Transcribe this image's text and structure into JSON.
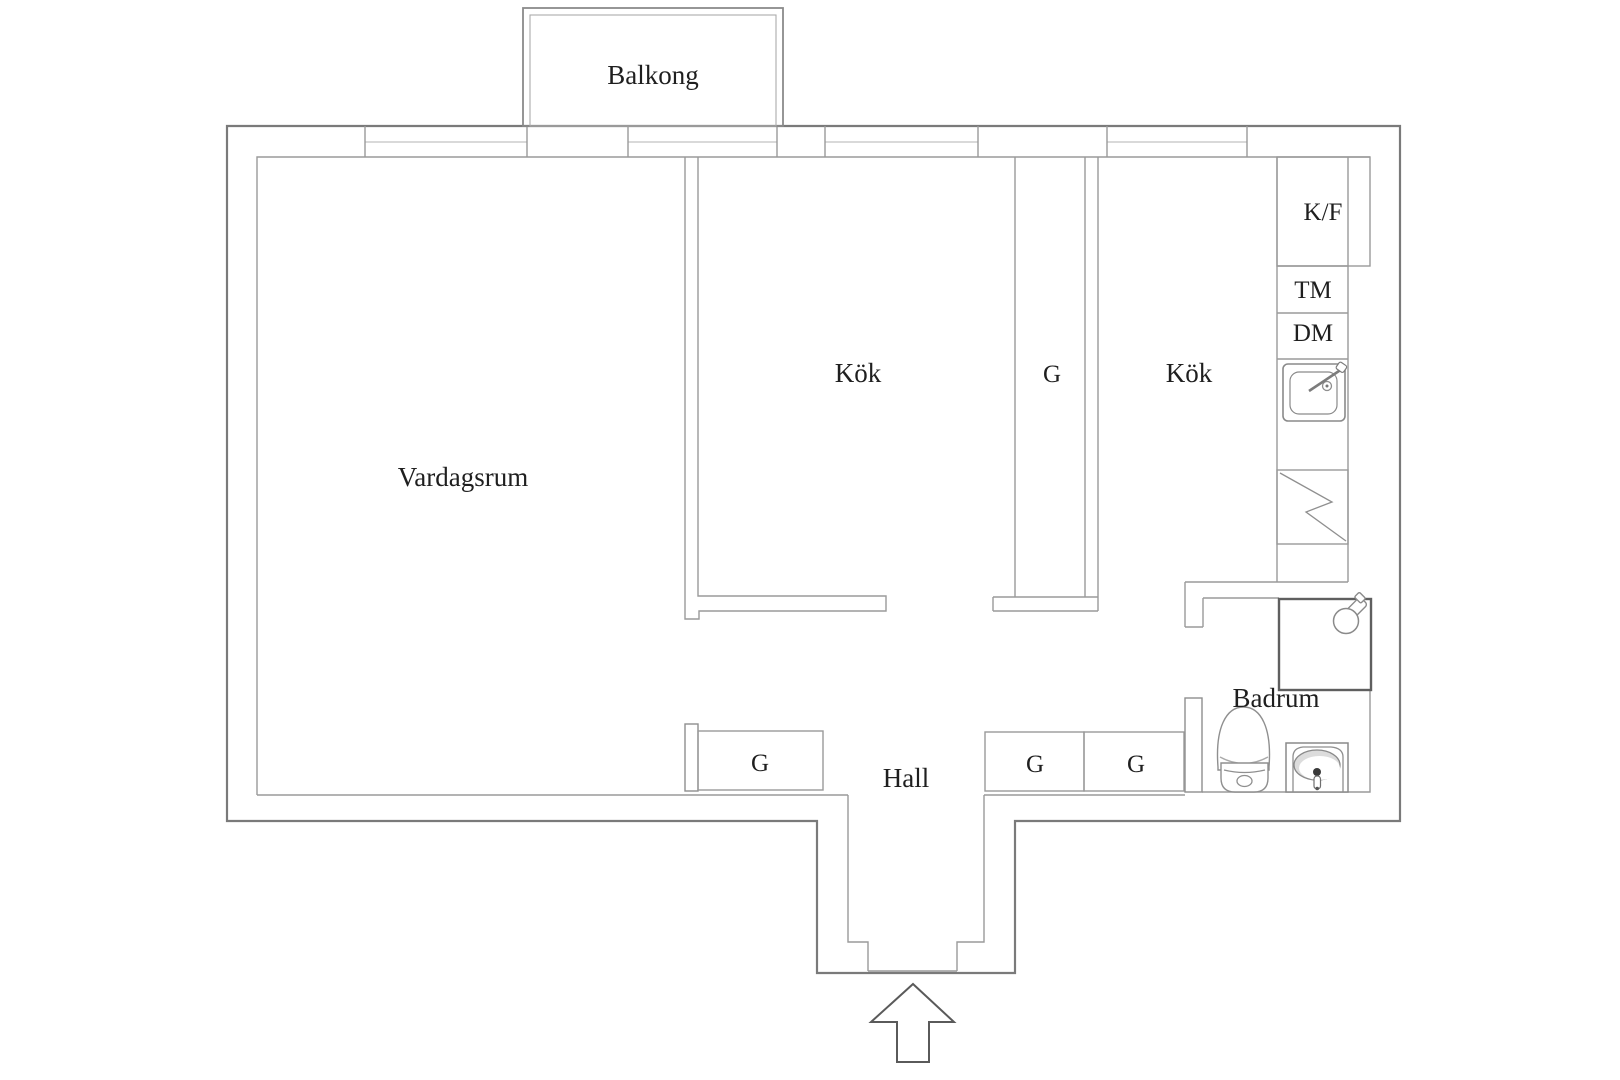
{
  "document": {
    "type": "floor-plan",
    "language": "Swedish"
  },
  "labels": {
    "balcony": "Balkong",
    "living_room": "Vardagsrum",
    "kitchen_mid": "Kök",
    "kitchen_right": "Kök",
    "hall": "Hall",
    "bathroom": "Badrum",
    "closet": "G",
    "fridge_freezer": "K/F",
    "washing_machine": "TM",
    "dishwasher": "DM"
  },
  "icons": {
    "kitchen_sink": "kitchen-sink-icon",
    "stove": "stove-lightning-icon",
    "shower": "shower-icon",
    "shower_head": "shower-head-icon",
    "toilet": "toilet-icon",
    "bathroom_sink": "bathroom-sink-icon",
    "entry_arrow": "entry-arrow-icon"
  },
  "colors": {
    "wall": "#7a7a7a",
    "line": "#9a9a9a",
    "light_line": "#b3b3b3",
    "dark_line": "#5f5f5f",
    "text": "#1f1f1f",
    "background": "#ffffff"
  }
}
